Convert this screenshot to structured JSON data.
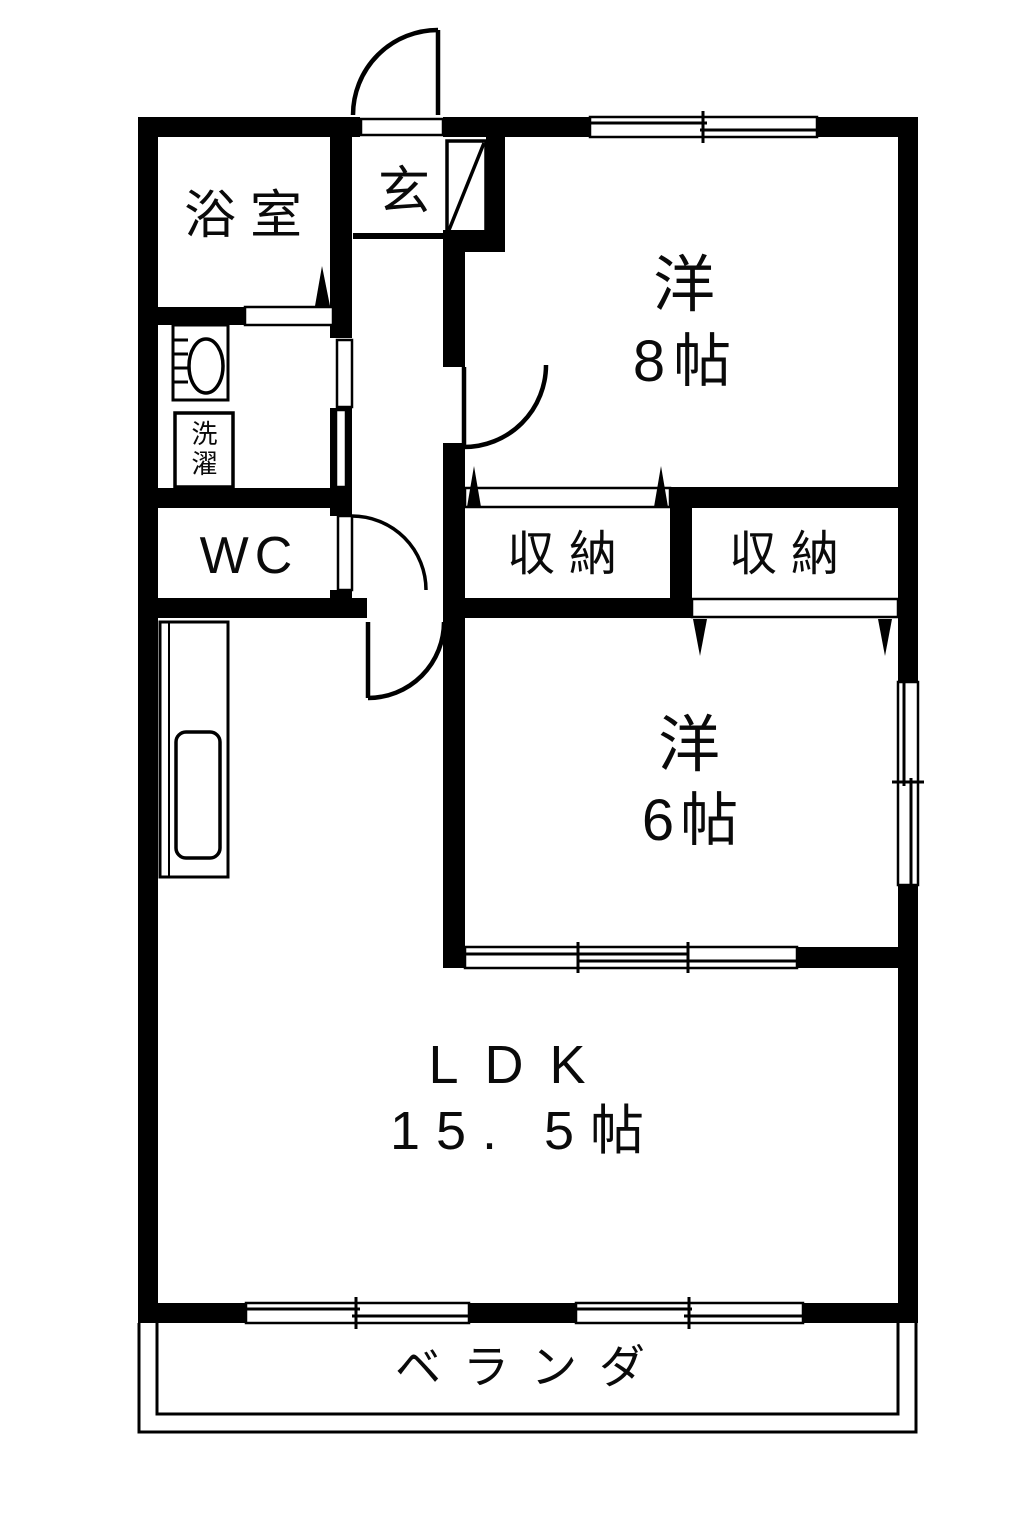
{
  "floorplan": {
    "rooms": {
      "bath": {
        "label": "浴室"
      },
      "entrance": {
        "label": "玄"
      },
      "western_room_8": {
        "name": "洋",
        "size": "8帖"
      },
      "wc": {
        "label": "WC"
      },
      "laundry": {
        "label": "洗濯"
      },
      "closet_1": {
        "label": "収納"
      },
      "closet_2": {
        "label": "収納"
      },
      "western_room_6": {
        "name": "洋",
        "size": "6帖"
      },
      "ldk": {
        "name": "LDK",
        "size": "15. 5帖"
      },
      "veranda": {
        "label": "ベランダ"
      }
    },
    "colors": {
      "wall": "#000000",
      "floor": "#ffffff"
    }
  }
}
